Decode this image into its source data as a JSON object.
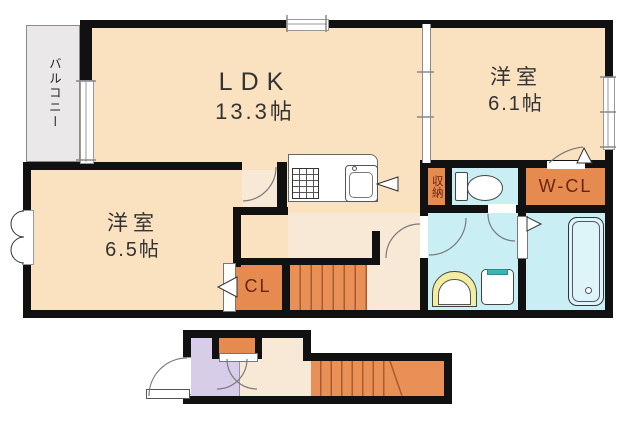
{
  "plan": {
    "labels": {
      "balcony": "バルコニー",
      "ldk": {
        "name": "LDK",
        "size": "13.3帖"
      },
      "bedroom_right": {
        "name": "洋室",
        "size": "6.1帖"
      },
      "bedroom_left": {
        "name": "洋室",
        "size": "6.5帖"
      },
      "storage": "収納",
      "walk_in_closet": "W-CL",
      "closet": "CL"
    },
    "icons": [
      "kitchen-sink-icon",
      "stove-icon",
      "toilet-icon",
      "bathtub-icon",
      "washbasin-icon",
      "washing-machine-icon",
      "stairs",
      "door-arc-icon",
      "window-icon"
    ],
    "colors": {
      "wall": "#111111",
      "room": "#FAE1C0",
      "hall": "#F8E9D6",
      "closet-orange": "#E58B50",
      "stair": "#E89055",
      "stair-line": "#A85A32",
      "water-blue": "#C9EFF4",
      "tub-blue": "#DDF4F9",
      "entrance-lavender": "#D8CDE9",
      "balcony-gray": "#EAE8E9",
      "label-text": "#333333",
      "closet-text": "#6B2410",
      "basin-yellow": "#F2EDA0",
      "washer-teal": "#35B6B3"
    }
  }
}
